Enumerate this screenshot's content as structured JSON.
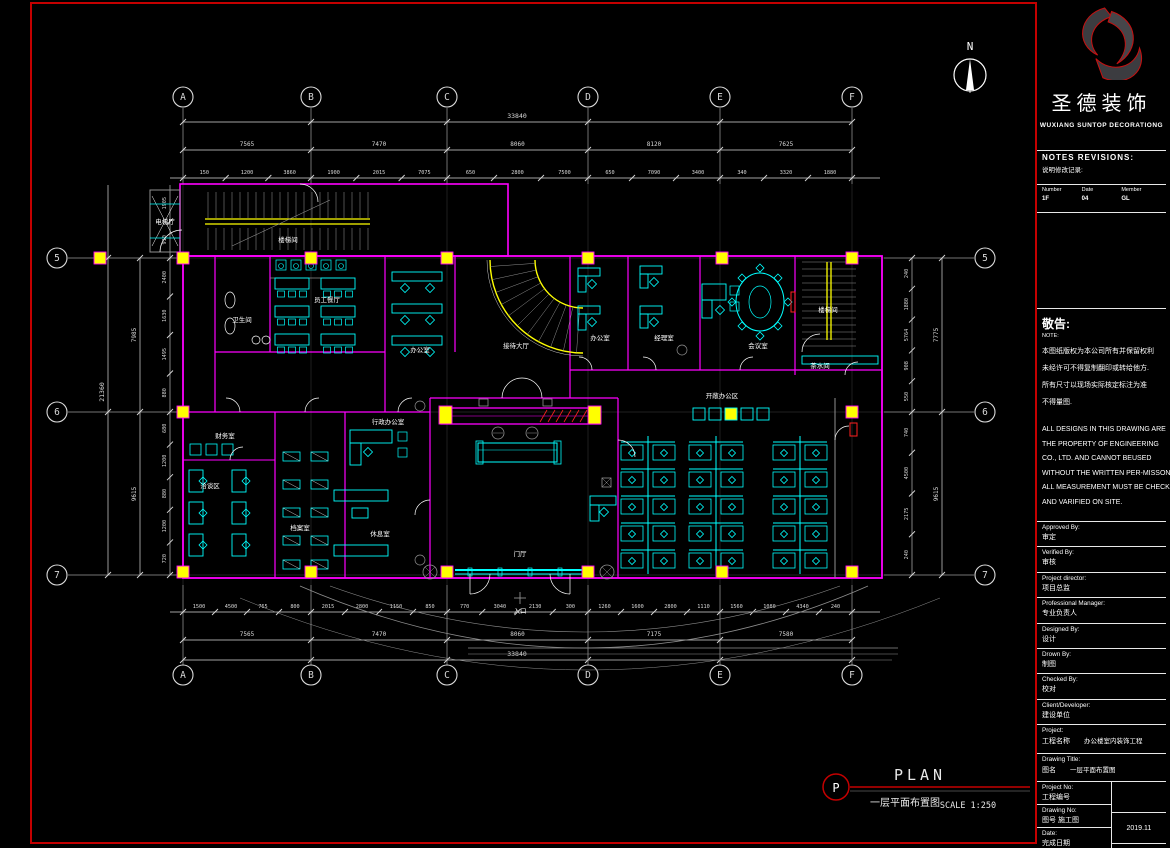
{
  "brand": {
    "cn": "圣德装饰",
    "en": "WUXIANG SUNTOP  DECORATIONG"
  },
  "north_label": "N",
  "plan_footer": {
    "bubble": "P",
    "title": "PLAN",
    "subtitle_cn": "一层平面布置图",
    "scale": "SCALE 1:250"
  },
  "grid": {
    "cols": [
      "A",
      "B",
      "C",
      "D",
      "E",
      "F"
    ],
    "rows": [
      "5",
      "6",
      "7"
    ]
  },
  "dimensions": {
    "total_width": "33840",
    "top_bays": [
      "7565",
      "7470",
      "8060",
      "8120",
      "7625"
    ],
    "top_sub": [
      "150",
      "1200",
      "3860",
      "1900",
      "2015",
      "7075",
      "650",
      "2800",
      "7500",
      "650",
      "7090",
      "3400",
      "340",
      "3320",
      "1880"
    ],
    "bottom_bays": [
      "7565",
      "7470",
      "8060",
      "7175",
      "7580"
    ],
    "bottom_sub": [
      "1500",
      "4500",
      "765",
      "800",
      "2015",
      "2800",
      "1150",
      "850",
      "770",
      "3040",
      "2130",
      "300",
      "1260",
      "1600",
      "2800",
      "1110",
      "1560",
      "1080",
      "4340",
      "240"
    ],
    "left_total": "21360",
    "left_bays": [
      "7985",
      "9615"
    ],
    "left_sub": [
      "1905",
      "910",
      "2400",
      "1630",
      "1495",
      "880",
      "680",
      "1200",
      "880",
      "1200",
      "720"
    ],
    "right_bays": [
      "7775",
      "9615"
    ],
    "right_sub": [
      "240",
      "1880",
      "5764",
      "908",
      "550",
      "740",
      "4500",
      "2175",
      "240"
    ]
  },
  "rooms": [
    {
      "label": "电梯厅",
      "x": 165,
      "y": 224
    },
    {
      "label": "楼梯间",
      "x": 288,
      "y": 242
    },
    {
      "label": "卫生间",
      "x": 242,
      "y": 322
    },
    {
      "label": "员工餐厅",
      "x": 327,
      "y": 302
    },
    {
      "label": "办公室",
      "x": 420,
      "y": 352
    },
    {
      "label": "接待大厅",
      "x": 516,
      "y": 348
    },
    {
      "label": "办公室",
      "x": 600,
      "y": 340
    },
    {
      "label": "经理室",
      "x": 664,
      "y": 340
    },
    {
      "label": "会议室",
      "x": 758,
      "y": 348
    },
    {
      "label": "楼梯间",
      "x": 828,
      "y": 312
    },
    {
      "label": "茶水间",
      "x": 820,
      "y": 368
    },
    {
      "label": "财务室",
      "x": 225,
      "y": 438
    },
    {
      "label": "洽谈区",
      "x": 210,
      "y": 488
    },
    {
      "label": "档案室",
      "x": 300,
      "y": 530
    },
    {
      "label": "行政办公室",
      "x": 388,
      "y": 424
    },
    {
      "label": "休息室",
      "x": 380,
      "y": 536
    },
    {
      "label": "门厅",
      "x": 520,
      "y": 556
    },
    {
      "label": "开敞办公区",
      "x": 722,
      "y": 398
    },
    {
      "label": "入口",
      "x": 520,
      "y": 613
    }
  ],
  "notes": {
    "header": "NOTES  REVISIONS:",
    "header_cn": "说明修改记录:",
    "columns": [
      "Number",
      "Date",
      "Member"
    ],
    "values": [
      "1F",
      "04",
      "GL"
    ]
  },
  "notice": {
    "title": "敬告:",
    "subtitle": "NOTE:",
    "cn_lines": [
      "本图纸版权为本公司所有并保留权利",
      "未经许可不得复制翻印或转给他方.",
      "所有尺寸以现场实际核定标注为准",
      "不得量图."
    ],
    "en_lines": [
      "ALL DESIGNS IN THIS DRAWING ARE",
      "THE PROPERTY OF ENGINEERING",
      "CO., LTD. AND CANNOT BEUSED",
      "WITHOUT THE WRITTEN PER-MISSON",
      "ALL MEASUREMENT MUST BE CHECKED",
      "AND VARIFIED ON SITE."
    ]
  },
  "title_block": {
    "fields": [
      {
        "label": "Approved By:",
        "value": "审定"
      },
      {
        "label": "Verified By:",
        "value": "审核"
      },
      {
        "label": "Project director:",
        "value": "项目总监"
      },
      {
        "label": "Professional  Manager:",
        "value": "专业负责人"
      },
      {
        "label": "Designed By:",
        "value": "设计"
      },
      {
        "label": "Drown By:",
        "value": "制图"
      },
      {
        "label": "Checked By:",
        "value": "校对"
      },
      {
        "label": "Client/Developer:",
        "value": "建设单位"
      },
      {
        "label": "Project:",
        "value": "工程名称",
        "value2": "办公楼室内装饰工程"
      },
      {
        "label": "Drawing Title:",
        "value": "图名",
        "value2": "一层平面布置图"
      }
    ],
    "bottom": {
      "project_no_label": "Project No:",
      "project_no_value": "工程编号",
      "drawing_no_label": "Drawing No:",
      "drawing_no_value": "图号  施工图",
      "date_label": "Date:",
      "date_value": "完成日期",
      "date_right": "2019.11"
    }
  }
}
